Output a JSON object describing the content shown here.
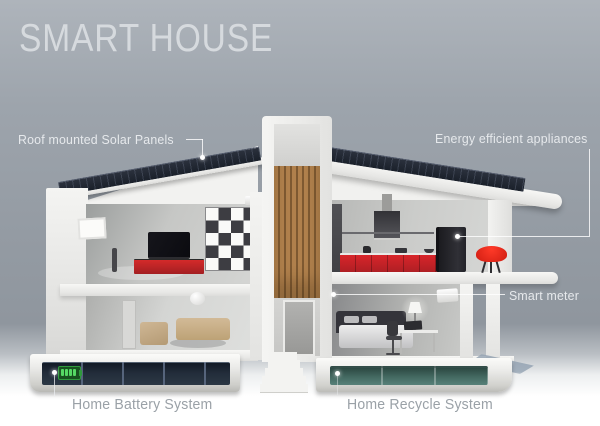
{
  "title": "SMART HOUSE",
  "callouts": {
    "solar_panels": "Roof mounted Solar Panels",
    "appliances": "Energy efficient appliances",
    "smart_meter": "Smart meter",
    "battery": "Home Battery System",
    "recycle": "Home Recycle System"
  },
  "icons": {
    "battery_indicator": "battery-charge-icon",
    "connector_markers": "white-dot-callout-markers"
  },
  "colors": {
    "background_top": "#aeb4bb",
    "background_mid": "#9098a0",
    "ground": "#ffffff",
    "title_text": "#d6dade",
    "callout_text_light": "#e6e9ec",
    "callout_text_gray": "#9aa1a7",
    "solar_panel": "#1a202a",
    "house_white": "#f3f3f1",
    "accent_red": "#d8252a",
    "wood_slats": "#a97a46",
    "battery_strip": "#1c2430",
    "battery_green": "#55d964",
    "recycle_glass": "#446a62"
  }
}
